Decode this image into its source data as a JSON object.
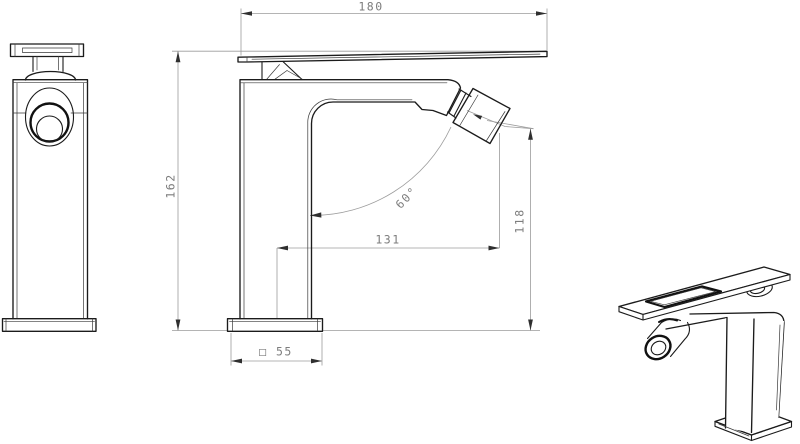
{
  "colors": {
    "background": "#ffffff",
    "linework": "#1b1b1b",
    "dimension_lines": "#9c9c9c",
    "dimension_text": "#7d7d7d",
    "arrowheads": "#2f2f2f"
  },
  "dimensions": {
    "overall_width": "180",
    "overall_height": "162",
    "spout_reach": "131",
    "outlet_height": "118",
    "outlet_angle": "60°",
    "base_square": "□ 55"
  }
}
